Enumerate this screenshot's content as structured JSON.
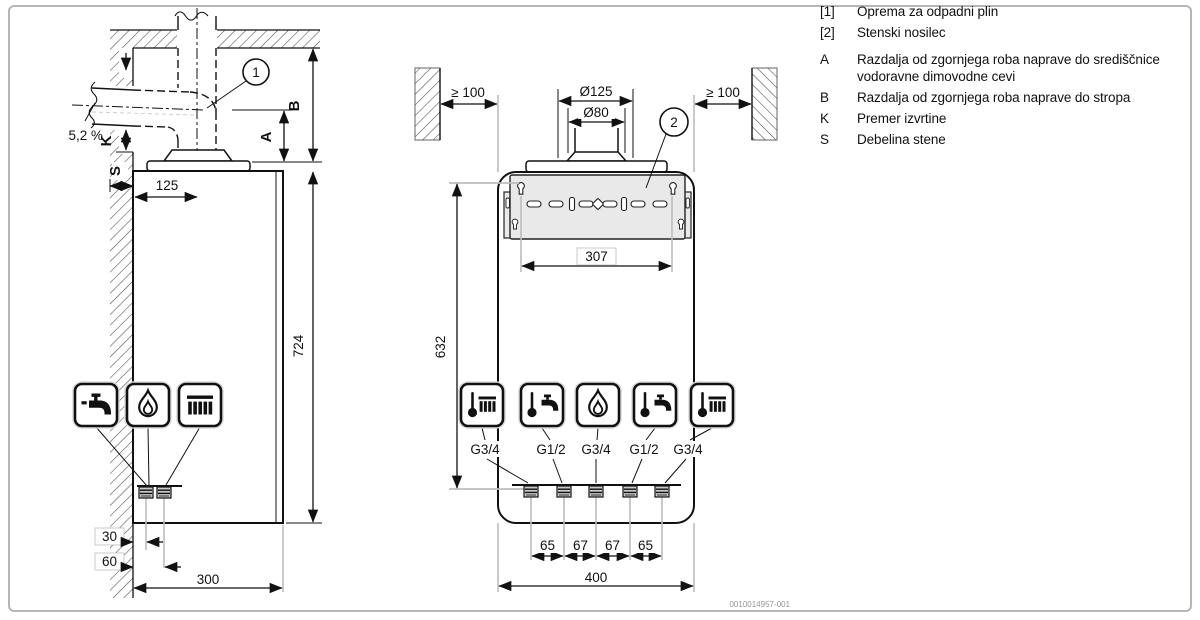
{
  "legend": {
    "items": [
      {
        "key": "[1]",
        "text": "Oprema za odpadni plin"
      },
      {
        "key": "[2]",
        "text": "Stenski nosilec"
      },
      {
        "key": "A",
        "text": "Razdalja od zgornjega roba naprave do središčnice vodoravne dimovodne cevi"
      },
      {
        "key": "B",
        "text": "Razdalja od zgornjega roba naprave do stropa"
      },
      {
        "key": "K",
        "text": "Premer izvrtine"
      },
      {
        "key": "S",
        "text": "Debelina stene"
      }
    ]
  },
  "side_view": {
    "slope_label": "5,2 %",
    "callout": "1",
    "dim_k": "K",
    "dim_s": "S",
    "dim_a": "A",
    "dim_b": "B",
    "dim_125": "125",
    "dim_724": "724",
    "dim_30": "30",
    "dim_60": "60",
    "dim_300": "300",
    "icons": [
      "tap-icon",
      "flame-icon",
      "radiator-icon"
    ]
  },
  "front_view": {
    "clearance_left": "≥ 100",
    "clearance_right": "≥ 100",
    "dia_outer": "Ø125",
    "dia_inner": "Ø80",
    "callout": "2",
    "dim_307": "307",
    "dim_632": "632",
    "dim_seg1": "65",
    "dim_seg2": "67",
    "dim_seg3": "67",
    "dim_seg4": "65",
    "dim_400": "400",
    "connections": [
      {
        "icon": "thermometer-radiator-icon",
        "size": "G3/4"
      },
      {
        "icon": "thermometer-tap-icon",
        "size": "G1/2"
      },
      {
        "icon": "flame-icon",
        "size": "G3/4"
      },
      {
        "icon": "thermometer-tap-icon",
        "size": "G1/2"
      },
      {
        "icon": "thermometer-radiator-icon",
        "size": "G3/4"
      }
    ]
  },
  "watermark": "0010014957-001",
  "colors": {
    "line": "#111111",
    "guide": "#bdbdbd",
    "bracket_fill": "#e9e9e9",
    "frame": "#b6b6ba"
  }
}
